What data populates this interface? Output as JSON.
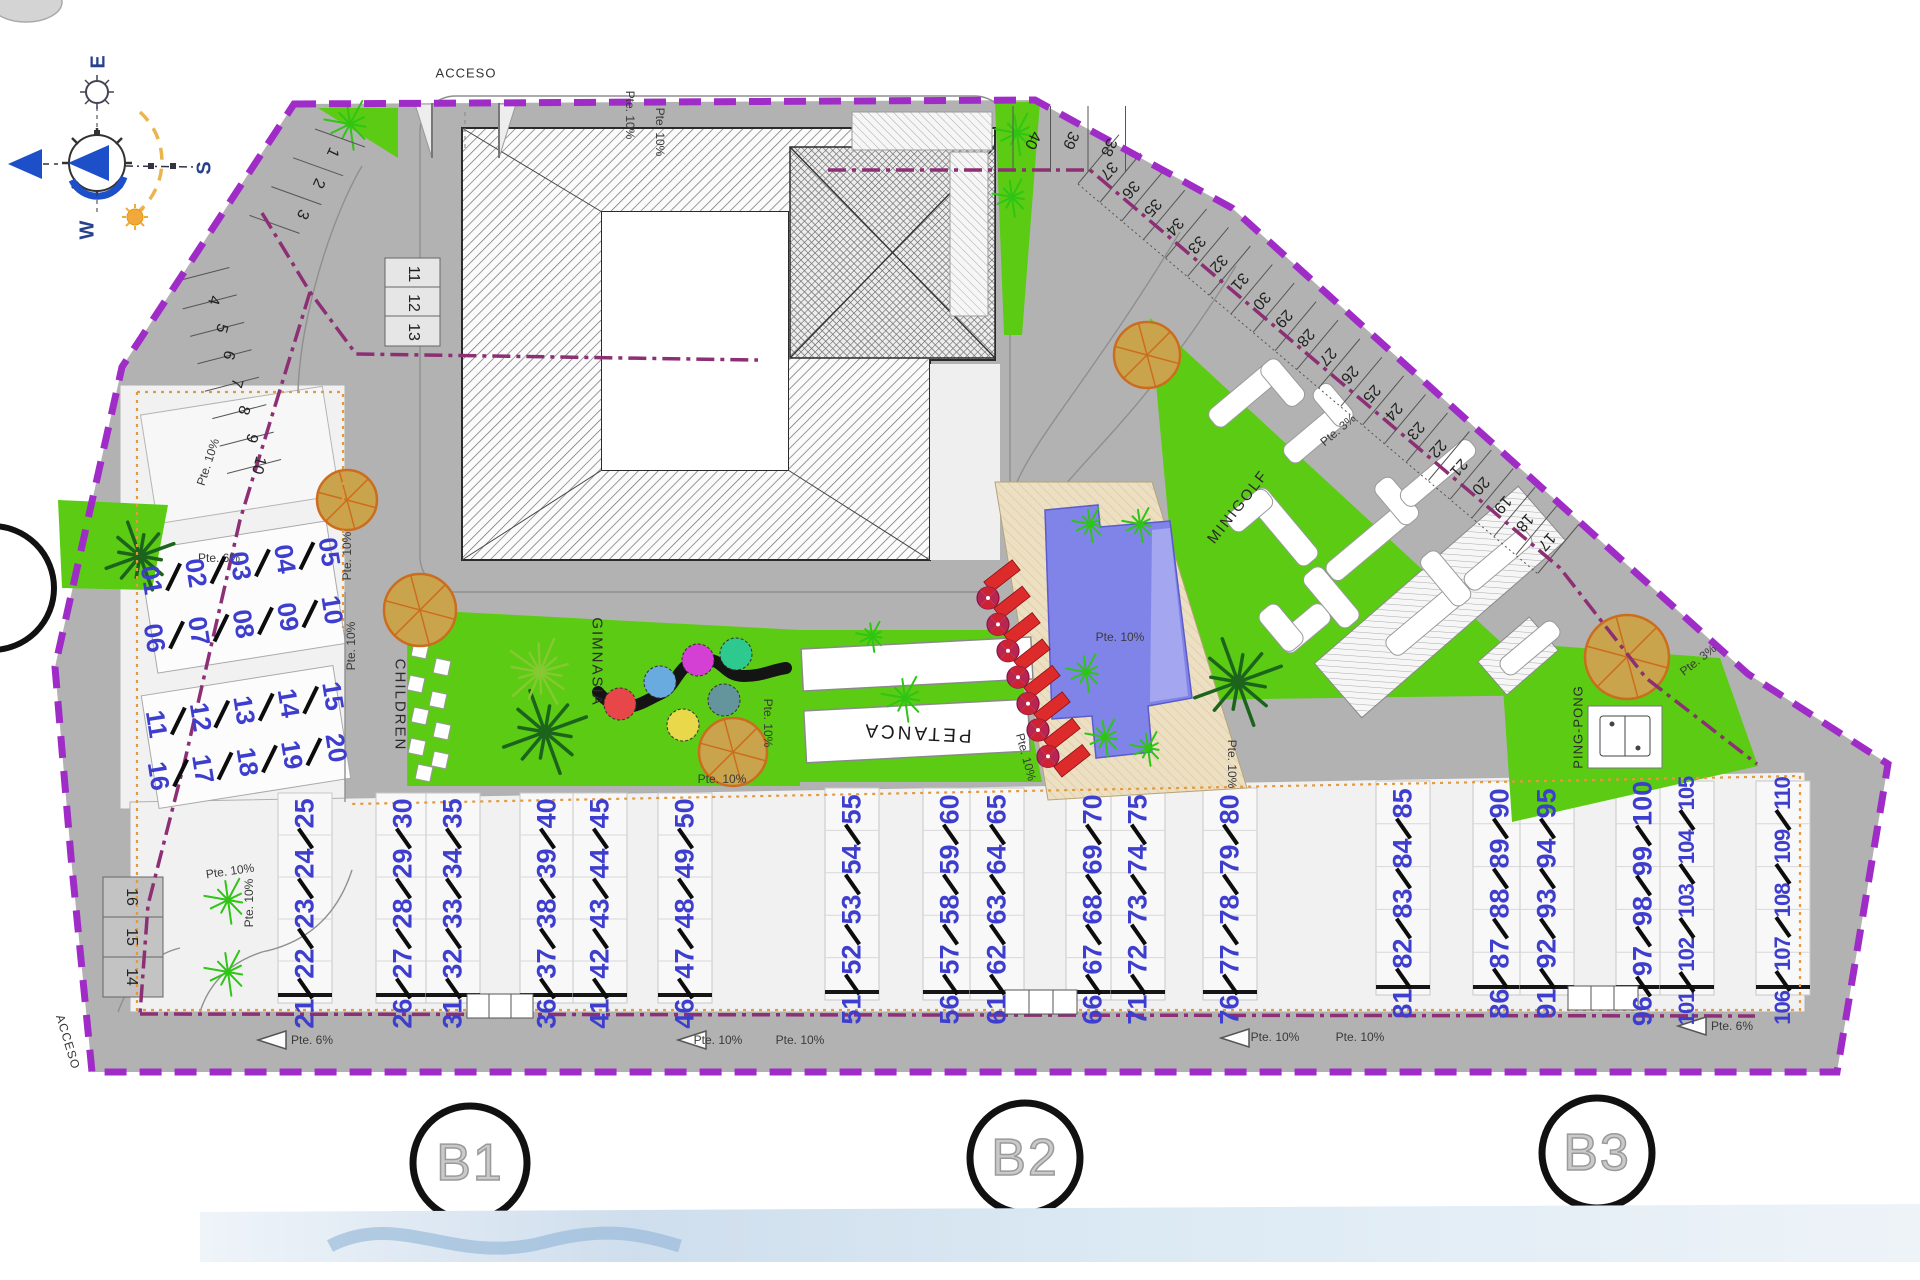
{
  "compass": {
    "east": "E",
    "south": "S",
    "west": "W"
  },
  "access": {
    "top": "ACCESO",
    "bottom": "ACCESO"
  },
  "areas": {
    "children": "CHILDREN",
    "gymnasium": "GIMNASIA",
    "petanque": "PETANCA",
    "minigolf": "MINIGOLF",
    "ping_pong": "PING-PONG"
  },
  "blocks": [
    {
      "label": "B1"
    },
    {
      "label": "B2"
    },
    {
      "label": "B3"
    }
  ],
  "slopes": {
    "pte10": "Pte. 10%",
    "pte6": "Pte. 6%",
    "pte3": "Pte. 3%"
  },
  "parking": {
    "northwest_upper": [
      "1",
      "2",
      "3"
    ],
    "northwest_lower": [
      "4",
      "5",
      "6",
      "7",
      "8",
      "9",
      "10"
    ],
    "box": [
      "11",
      "12",
      "13"
    ],
    "northeast_top": [
      "40",
      "39",
      "38"
    ],
    "northeast_diagonal": [
      "37",
      "36",
      "35",
      "34",
      "33",
      "32",
      "31",
      "30",
      "29",
      "28",
      "27",
      "26",
      "25",
      "24",
      "23",
      "22",
      "21",
      "20",
      "19",
      "18",
      "17"
    ],
    "southwest": [
      "16",
      "15",
      "14"
    ]
  },
  "units": {
    "left_rows": [
      [
        "01",
        "02",
        "03",
        "04",
        "05"
      ],
      [
        "06",
        "07",
        "08",
        "09",
        "10"
      ],
      [
        "11",
        "12",
        "13",
        "14",
        "15"
      ],
      [
        "16",
        "17",
        "18",
        "19",
        "20"
      ]
    ],
    "b1_strips": [
      [
        "21",
        "22",
        "23",
        "24",
        "25"
      ],
      [
        "26",
        "27",
        "28",
        "29",
        "30"
      ],
      [
        "31",
        "32",
        "33",
        "34",
        "35"
      ],
      [
        "36",
        "37",
        "38",
        "39",
        "40"
      ],
      [
        "41",
        "42",
        "43",
        "44",
        "45"
      ],
      [
        "46",
        "47",
        "48",
        "49",
        "50"
      ]
    ],
    "b2_strips": [
      [
        "51",
        "52",
        "53",
        "54",
        "55"
      ],
      [
        "56",
        "57",
        "58",
        "59",
        "60"
      ],
      [
        "61",
        "62",
        "63",
        "64",
        "65"
      ],
      [
        "66",
        "67",
        "68",
        "69",
        "70"
      ],
      [
        "71",
        "72",
        "73",
        "74",
        "75"
      ],
      [
        "76",
        "77",
        "78",
        "79",
        "80"
      ]
    ],
    "b3_strips": [
      [
        "81",
        "82",
        "83",
        "84",
        "85"
      ],
      [
        "86",
        "87",
        "88",
        "89",
        "90"
      ],
      [
        "91",
        "92",
        "93",
        "94",
        "95"
      ],
      [
        "96",
        "97",
        "98",
        "99",
        "100"
      ],
      [
        "101",
        "102",
        "103",
        "104",
        "105"
      ],
      [
        "106",
        "107",
        "108",
        "109",
        "110"
      ]
    ]
  },
  "colors": {
    "boundary_purple": "#a02cc8",
    "inner_boundary": "#8c2f74",
    "green": "#5bcb14",
    "unit_number_blue": "#3e3ece",
    "pool_blue": "#8084e8",
    "deck_beige": "#ecdfc2",
    "sunbed_red": "#dd2b2b",
    "tree_orange": "#cc6d1e",
    "plot_line_orange": "#e2993f"
  }
}
